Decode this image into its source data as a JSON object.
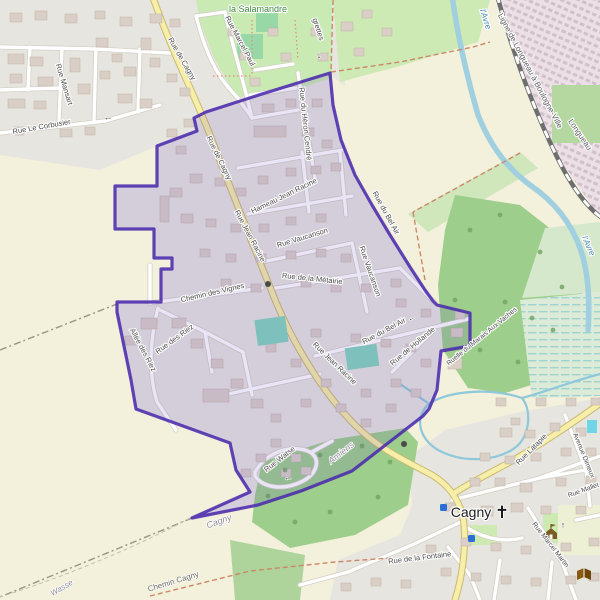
{
  "map": {
    "title": "Map of commune boundary at Cagny / Amiens",
    "labels": [
      {
        "name": "la-salamandre",
        "text": "la Salamandre"
      },
      {
        "name": "aigrettes",
        "text": "grettes"
      },
      {
        "name": "rue-mansart",
        "text": "Rue Mansart"
      },
      {
        "name": "rue-le-corbusier",
        "text": "Rue Le Corbusier"
      },
      {
        "name": "rue-marcel-paul",
        "text": "Rue Marcel Paul"
      },
      {
        "name": "rue-de-cagny-1",
        "text": "Rue de Cagny"
      },
      {
        "name": "rue-de-cagny-2",
        "text": "Rue de Cagny"
      },
      {
        "name": "rue-du-heron-cendre",
        "text": "Rue du Héron Cendré"
      },
      {
        "name": "ligne-longueau",
        "text": "Ligne de Longueau à Boulogne-Ville"
      },
      {
        "name": "longueau",
        "text": "Longueau"
      },
      {
        "name": "avre-1",
        "text": "l'Avre"
      },
      {
        "name": "avre-2",
        "text": "l'Avre"
      },
      {
        "name": "hameau-jean-racine",
        "text": "Hameau Jean Racine"
      },
      {
        "name": "rue-jean-racine-1",
        "text": "Rue Jean Racine"
      },
      {
        "name": "rue-vaucanson-1",
        "text": "Rue Vaucanson"
      },
      {
        "name": "rue-vaucanson-2",
        "text": "Rue Vaucanson"
      },
      {
        "name": "rue-de-la-metairie",
        "text": "Rue de la Métairie"
      },
      {
        "name": "chemin-des-vignes",
        "text": "Chemin des Vignes"
      },
      {
        "name": "rue-du-bel-air-1",
        "text": "Rue du Bel Air"
      },
      {
        "name": "allee-des-riez",
        "text": "Allée des Riez"
      },
      {
        "name": "rue-des-riez",
        "text": "Rue des Riez"
      },
      {
        "name": "rue-du-bel-air-2",
        "text": "Rue du Bel Air"
      },
      {
        "name": "rue-de-hollande",
        "text": "Rue de Hollande"
      },
      {
        "name": "ruelle-du-marais-aux-vaches",
        "text": "Ruelle du Marais Aux Vaches"
      },
      {
        "name": "rue-jean-racine-2",
        "text": "Rue Jean Racine"
      },
      {
        "name": "rue-watse",
        "text": "Rue Watse"
      },
      {
        "name": "amiens-admin",
        "text": "Amiens"
      },
      {
        "name": "cagny-admin",
        "text": "Cagny"
      },
      {
        "name": "wasse",
        "text": "Wasse"
      },
      {
        "name": "chemin-cagny",
        "text": "Chemin Cagny"
      },
      {
        "name": "rue-de-la-fontaine",
        "text": "Rue de la Fontaine"
      },
      {
        "name": "cagny-place",
        "text": "Cagny"
      },
      {
        "name": "rue-latapie",
        "text": "Rue Latapie"
      },
      {
        "name": "avenue-dimeux",
        "text": "Avenue Dimeux"
      },
      {
        "name": "rue-mallet",
        "text": "Rue Mallet"
      },
      {
        "name": "rue-marcel-martin",
        "text": "Rue Marcel Martin"
      }
    ],
    "icons": {
      "church": {
        "glyph": "✝"
      },
      "arrow_left": {
        "glyph": "←"
      },
      "arrow_up": {
        "glyph": "↑"
      },
      "arrow_down": {
        "glyph": "↓"
      }
    },
    "colors": {
      "boundary_stroke": "#4b2aad",
      "boundary_fill": "rgba(86,53,185,0.13)",
      "road_yellow": "#f6eea9",
      "water": "#a8d0e0",
      "park_green": "#c9eab3",
      "forest_green": "#9dce8c",
      "pitch_teal": "#85d6bd",
      "industrial_pink": "#ecdfe6",
      "farmland": "#f3f0dc",
      "residential": "#e7e5df",
      "building": "#d9cfc7"
    }
  }
}
